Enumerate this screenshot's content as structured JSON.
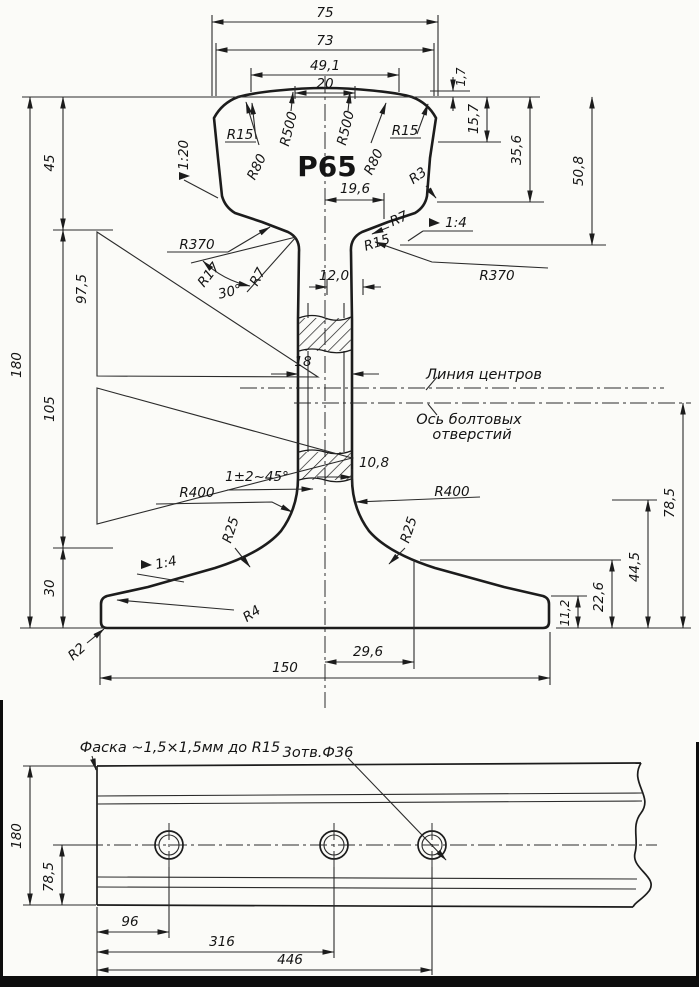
{
  "main_view": {
    "designation": "Р65",
    "top_dims": {
      "w75": "75",
      "w73": "73",
      "w49_1": "49,1",
      "w20": "20"
    },
    "right_dims": {
      "h1_7": "1,7",
      "h15_7": "15,7",
      "h35_6": "35,6",
      "h50_8": "50,8",
      "h78_5": "78,5",
      "h44_5": "44,5",
      "h22_6": "22,6",
      "h11_2": "11,2"
    },
    "left_dims": {
      "h45": "45",
      "h97_5": "97,5",
      "h180": "180",
      "h105": "105",
      "h30": "30"
    },
    "inner_dims": {
      "w19_6": "19,6",
      "w12_0": "12,0",
      "w18": "18",
      "w10_8": "10,8",
      "w29_6": "29,6",
      "w150": "150"
    },
    "radii": {
      "r15_head_left": "R15",
      "r80_left": "R80",
      "r500_left": "R500",
      "r500_right": "R500",
      "r80_right": "R80",
      "r15_head_right": "R15",
      "r3": "R3",
      "r7_right": "R7",
      "r15_web_right": "R15",
      "r370_left": "R370",
      "r370_right": "R370",
      "r17": "R17",
      "r7_left": "R7",
      "r400_left": "R400",
      "r400_right": "R400",
      "r25_left": "R25",
      "r25_right": "R25",
      "r4": "R4",
      "r2": "R2"
    },
    "slopes": {
      "head_left": "1:20",
      "head_right": "1:4",
      "foot_left": "1:4"
    },
    "angle_30": "30°",
    "chamfer_note": "1±2~45°",
    "annotations": {
      "center_line": "Линия центров",
      "bolt_axis_line1": "Ось болтовых",
      "bolt_axis_line2": "отверстий"
    }
  },
  "side_view": {
    "chamfer_note": "Фаска ~1,5×1,5мм до R15",
    "holes_note": "3отв.Ф36",
    "dims": {
      "h180": "180",
      "h78_5": "78,5",
      "l96": "96",
      "l316": "316",
      "l446": "446"
    }
  }
}
